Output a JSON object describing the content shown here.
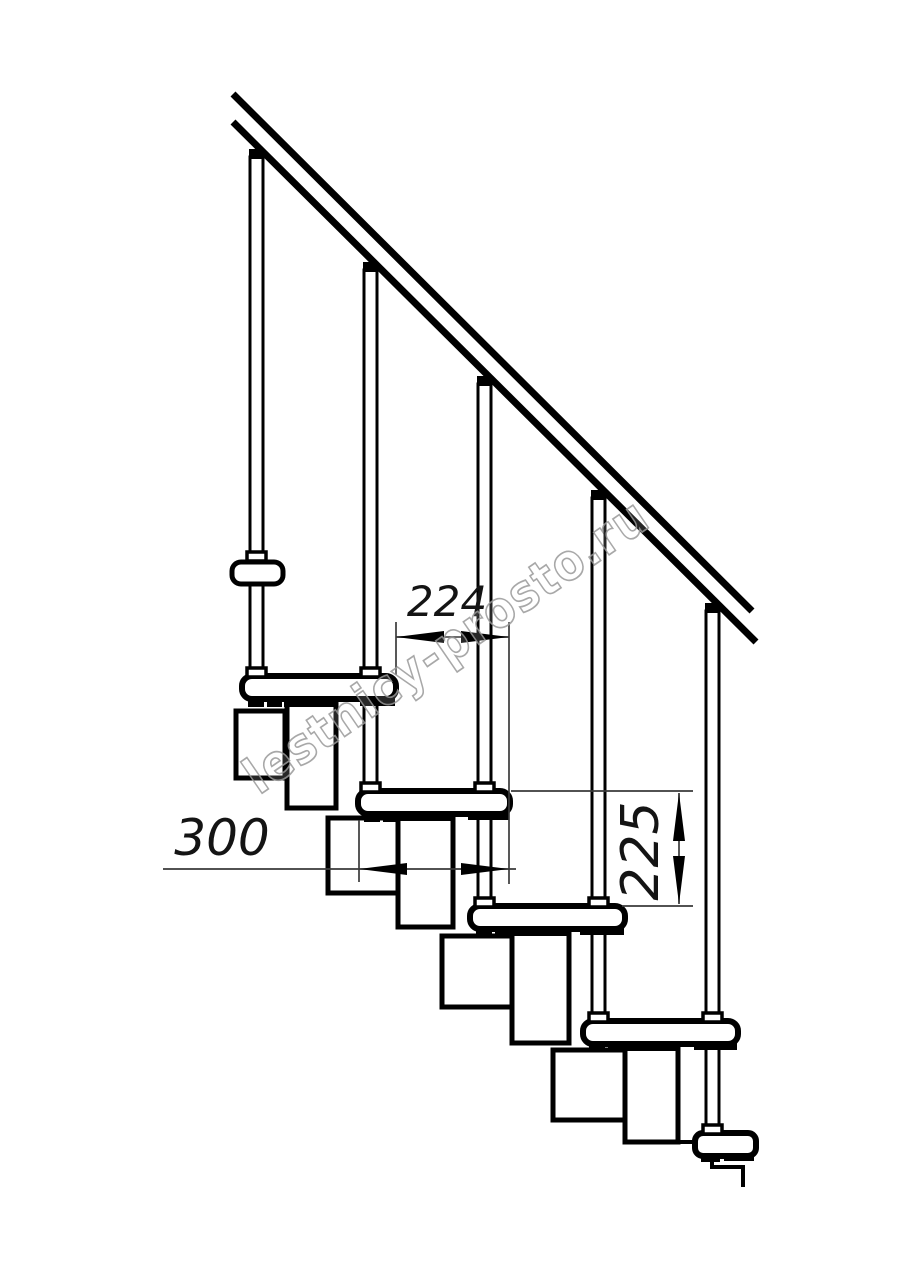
{
  "drawing": {
    "watermark": "lestnicy-prosto.ru",
    "dimensions": {
      "tread_run": "224",
      "tread_depth": "300",
      "step_rise": "225"
    },
    "colors": {
      "line": "#000000",
      "background": "#ffffff",
      "dimension_line": "#3a3a3a",
      "watermark_stroke": "#9a9a9a"
    }
  }
}
